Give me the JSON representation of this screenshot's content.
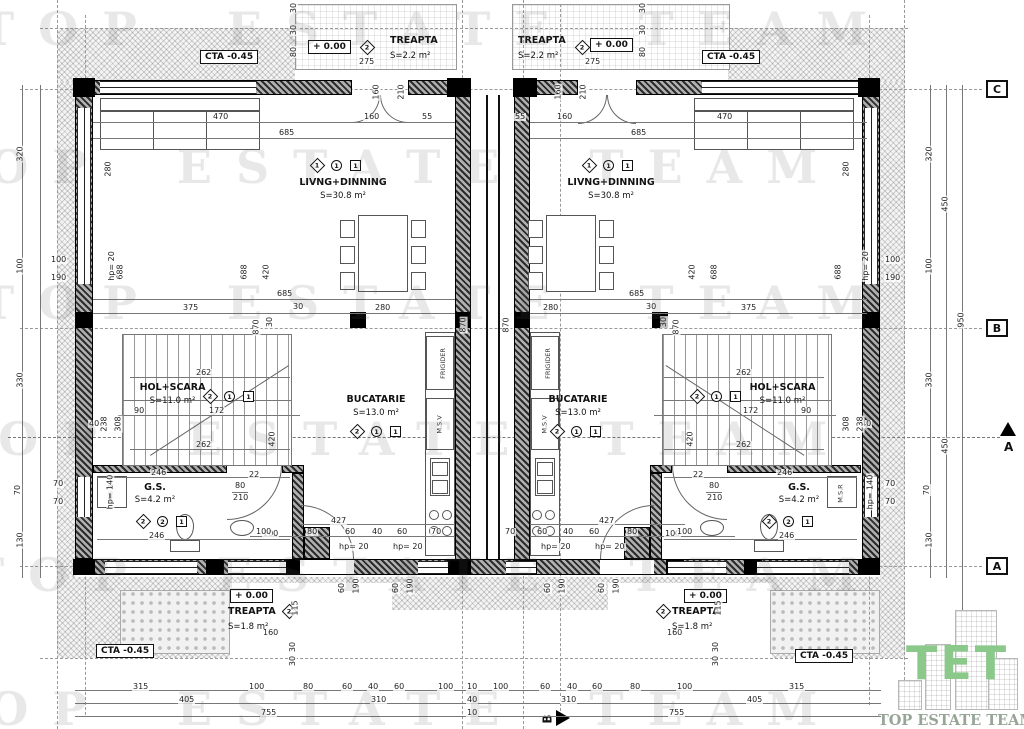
{
  "watermark": "TOP ESTATE TEAM",
  "logo": {
    "monogram": "TET",
    "name": "TOP ESTATE TEAM"
  },
  "boxes": {
    "cta": "CTA  -0.45",
    "level": "+ 0.00"
  },
  "grid": {
    "c": "C",
    "b": "B",
    "a": "A"
  },
  "sections": {
    "a": "A",
    "b": "B"
  },
  "rooms": {
    "living": {
      "name": "LIVNG+DINNING",
      "area": "S=30.8 m²",
      "diamond": "1",
      "circle": "1",
      "square": "1"
    },
    "kitchen": {
      "name": "BUCATARIE",
      "area": "S=13.0 m²",
      "diamond": "2",
      "circle": "1",
      "square": "1"
    },
    "hall": {
      "name": "HOL+SCARA",
      "area": "S=11.0 m²",
      "diamond": "2",
      "circle": "1",
      "square": "1"
    },
    "gs": {
      "name": "G.S.",
      "area": "S=4.2 m²",
      "diamond": "2",
      "circle": "2",
      "square": "1"
    },
    "treapta_top": {
      "name": "TREAPTA",
      "area": "S=2.2 m²",
      "diamond": "2",
      "width": "275"
    },
    "treapta_bottom": {
      "name": "TREAPTA",
      "area": "S=1.8 m²",
      "diamond": "2"
    }
  },
  "fixtures": {
    "fridge": "FRIGIDER",
    "dishwasher": "M.S.V",
    "washer": "M.S.R"
  },
  "dims": {
    "bottom1": [
      "315",
      "100",
      "80",
      "60",
      "40",
      "60",
      "100",
      "10",
      "100",
      "60",
      "40",
      "60",
      "80",
      "100",
      "315"
    ],
    "bottom2": [
      "405",
      "310",
      "40",
      "310",
      "405"
    ],
    "bottom3": [
      "755",
      "10",
      "755"
    ],
    "side": [
      "320",
      "100",
      "330",
      "70",
      "130"
    ],
    "side_mid": [
      "450",
      "450"
    ],
    "side_total": "950",
    "steps_v": [
      "30",
      "30",
      "80"
    ],
    "door": [
      "160",
      "210"
    ],
    "top_row": [
      "470",
      "685",
      "160",
      "55"
    ],
    "wall_v": [
      "280",
      "688",
      "688",
      "420",
      "870",
      "30"
    ],
    "mid_row": [
      "685",
      "375",
      "30",
      "280"
    ],
    "parapet": {
      "a": "100",
      "b": "190",
      "hp20": "hp= 20",
      "hp140": "hp= 140",
      "w70": "70",
      "w40": "40"
    },
    "stair": [
      "262",
      "90",
      "172",
      "262",
      "238",
      "308",
      "420"
    ],
    "gs": [
      "246",
      "246",
      "100",
      "80",
      "210",
      "22"
    ],
    "kitchen": [
      "427",
      "100",
      "80",
      "60",
      "40",
      "60",
      "70"
    ],
    "sill": [
      "60",
      "190"
    ],
    "treapta_b": [
      "160",
      "115",
      "30",
      "30"
    ]
  }
}
